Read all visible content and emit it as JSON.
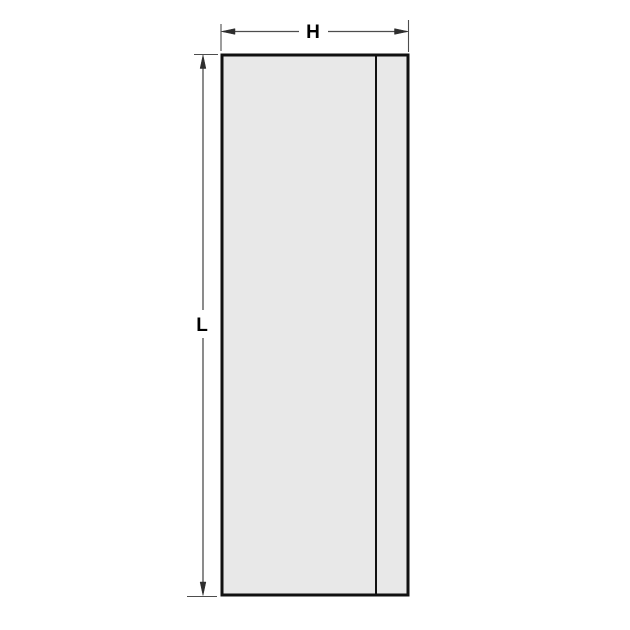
{
  "diagram": {
    "type": "technical-dimension-drawing",
    "labels": {
      "width_label": "H",
      "length_label": "L"
    },
    "colors": {
      "panel_fill": "#e8e8e8",
      "panel_outline": "#111111",
      "dimension_line": "#4d4d4d",
      "label_text": "#000000",
      "background": "#ffffff"
    },
    "parts": {
      "main_panel": "tall rectangle",
      "edge_strip": "narrow vertical strip at right edge of panel"
    }
  }
}
